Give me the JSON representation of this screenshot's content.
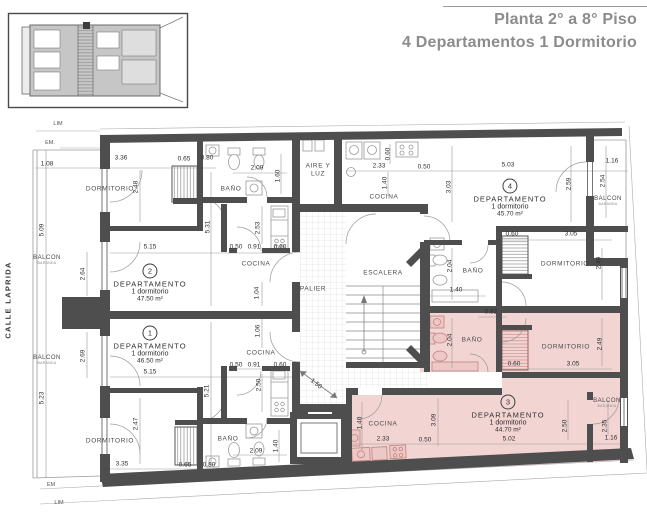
{
  "header": {
    "title_line1": "Planta 2° a 8° Piso",
    "title_line2": "4 Departamentos 1 Dormitorio"
  },
  "street_name": "CALLE LAPRIDA",
  "colors": {
    "highlight_pink": "#f2d5d3",
    "wall_gray": "#4e4e4e",
    "title_gray": "#8c8c8c"
  },
  "site_markers": [
    {
      "text": "LIM",
      "x": 58,
      "y": 124
    },
    {
      "text": "EM.",
      "x": 50,
      "y": 143
    },
    {
      "text": "EM",
      "x": 51,
      "y": 485
    },
    {
      "text": "LIM",
      "x": 59,
      "y": 503
    }
  ],
  "apartments": [
    {
      "number": "2",
      "name": "DEPARTAMENTO",
      "type": "1 dormitorio",
      "area": "47.50 m²",
      "x": 150,
      "y": 283
    },
    {
      "number": "1",
      "name": "DEPARTAMENTO",
      "type": "1 dormitorio",
      "area": "46.50 m²",
      "x": 150,
      "y": 345
    },
    {
      "number": "4",
      "name": "DEPARTAMENTO",
      "type": "1 dormitorio",
      "area": "45.70 m²",
      "x": 510,
      "y": 198
    },
    {
      "number": "3",
      "name": "DEPARTAMENTO",
      "type": "1 dormitorio",
      "area": "44.70 m²",
      "x": 508,
      "y": 414
    }
  ],
  "rooms": [
    {
      "label": "DORMITORIO",
      "x": 110,
      "y": 189
    },
    {
      "label": "BAÑO",
      "x": 231,
      "y": 189
    },
    {
      "label": "COCINA",
      "x": 256,
      "y": 264
    },
    {
      "label": "AIRE Y LUZ",
      "x": 318,
      "y": 171,
      "wrap": true
    },
    {
      "label": "ESCALERA",
      "x": 383,
      "y": 273
    },
    {
      "label": "PALIER",
      "x": 313,
      "y": 289
    },
    {
      "label": "COCINA",
      "x": 384,
      "y": 197
    },
    {
      "label": "DORMITORIO",
      "x": 565,
      "y": 264
    },
    {
      "label": "BAÑO",
      "x": 473,
      "y": 271
    },
    {
      "label": "BAÑO",
      "x": 472,
      "y": 340
    },
    {
      "label": "DORMITORIO",
      "x": 566,
      "y": 347
    },
    {
      "label": "COCINA",
      "x": 383,
      "y": 424
    },
    {
      "label": "DORMITORIO",
      "x": 110,
      "y": 441
    },
    {
      "label": "BAÑO",
      "x": 228,
      "y": 439
    },
    {
      "label": "COCINA",
      "x": 261,
      "y": 353
    }
  ],
  "balconies": [
    {
      "label": "BALCON",
      "note": "BARANDA",
      "x": 47,
      "y": 260
    },
    {
      "label": "BALCON",
      "note": "BARANDA",
      "x": 47,
      "y": 360
    },
    {
      "label": "BALCON",
      "note": "BARANDA",
      "x": 608,
      "y": 201
    },
    {
      "label": "BALCON",
      "note": "BARANDA",
      "x": 607,
      "y": 403
    }
  ],
  "dimensions": [
    {
      "value": "1.08",
      "x": 47,
      "y": 164
    },
    {
      "value": "3.36",
      "x": 121,
      "y": 158
    },
    {
      "value": "0.65",
      "x": 184,
      "y": 159
    },
    {
      "value": "0.80",
      "x": 207,
      "y": 158
    },
    {
      "value": "2.48",
      "x": 136,
      "y": 187,
      "rot": -90
    },
    {
      "value": "5.09",
      "x": 42,
      "y": 230,
      "rot": -90
    },
    {
      "value": "5.15",
      "x": 150,
      "y": 247
    },
    {
      "value": "5.31",
      "x": 208,
      "y": 227,
      "rot": -90
    },
    {
      "value": "2.64",
      "x": 83,
      "y": 274,
      "rot": -90
    },
    {
      "value": "2.69",
      "x": 83,
      "y": 356,
      "rot": -90
    },
    {
      "value": "5.23",
      "x": 42,
      "y": 398,
      "rot": -90
    },
    {
      "value": "5.15",
      "x": 150,
      "y": 372
    },
    {
      "value": "2.47",
      "x": 136,
      "y": 424,
      "rot": -90
    },
    {
      "value": "3.35",
      "x": 122,
      "y": 464
    },
    {
      "value": "0.65",
      "x": 185,
      "y": 465
    },
    {
      "value": "0.80",
      "x": 209,
      "y": 465
    },
    {
      "value": "2.09",
      "x": 257,
      "y": 168
    },
    {
      "value": "1.60",
      "x": 278,
      "y": 176,
      "rot": -90
    },
    {
      "value": "2.53",
      "x": 258,
      "y": 228,
      "rot": -90
    },
    {
      "value": "0.50",
      "x": 236,
      "y": 247
    },
    {
      "value": "0.91",
      "x": 254,
      "y": 247
    },
    {
      "value": "0.60",
      "x": 280,
      "y": 247
    },
    {
      "value": "1.04",
      "x": 257,
      "y": 293,
      "rot": -90
    },
    {
      "value": "1.06",
      "x": 258,
      "y": 331,
      "rot": -90
    },
    {
      "value": "0.50",
      "x": 236,
      "y": 365
    },
    {
      "value": "0.91",
      "x": 254,
      "y": 365
    },
    {
      "value": "0.60",
      "x": 280,
      "y": 365
    },
    {
      "value": "2.50",
      "x": 259,
      "y": 385,
      "rot": -90
    },
    {
      "value": "5.21",
      "x": 207,
      "y": 391,
      "rot": -90
    },
    {
      "value": "2.09",
      "x": 256,
      "y": 451
    },
    {
      "value": "1.40",
      "x": 276,
      "y": 446,
      "rot": -90
    },
    {
      "value": "1.50",
      "x": 316,
      "y": 384,
      "rot": 38
    },
    {
      "value": "2.33",
      "x": 379,
      "y": 166
    },
    {
      "value": "0.60",
      "x": 388,
      "y": 154,
      "rot": -90
    },
    {
      "value": "0.50",
      "x": 424,
      "y": 167
    },
    {
      "value": "1.40",
      "x": 385,
      "y": 183,
      "rot": -90
    },
    {
      "value": "3.03",
      "x": 449,
      "y": 187,
      "rot": -90
    },
    {
      "value": "5.03",
      "x": 508,
      "y": 165
    },
    {
      "value": "2.59",
      "x": 569,
      "y": 184,
      "rot": -90
    },
    {
      "value": "1.16",
      "x": 612,
      "y": 161
    },
    {
      "value": "2.54",
      "x": 603,
      "y": 181,
      "rot": -90
    },
    {
      "value": "0.60",
      "x": 512,
      "y": 234
    },
    {
      "value": "3.05",
      "x": 571,
      "y": 234
    },
    {
      "value": "2.49",
      "x": 599,
      "y": 263,
      "rot": -90
    },
    {
      "value": "2.04",
      "x": 450,
      "y": 266,
      "rot": -90
    },
    {
      "value": "1.40",
      "x": 456,
      "y": 290
    },
    {
      "value": "0.82",
      "x": 491,
      "y": 312
    },
    {
      "value": "2.04",
      "x": 450,
      "y": 340,
      "rot": -90
    },
    {
      "value": "2.49",
      "x": 600,
      "y": 344,
      "rot": -90
    },
    {
      "value": "0.60",
      "x": 514,
      "y": 364
    },
    {
      "value": "3.05",
      "x": 573,
      "y": 364
    },
    {
      "value": "1.40",
      "x": 360,
      "y": 423,
      "rot": -90
    },
    {
      "value": "3.09",
      "x": 434,
      "y": 420,
      "rot": -90
    },
    {
      "value": "2.33",
      "x": 383,
      "y": 439
    },
    {
      "value": "0.50",
      "x": 425,
      "y": 440
    },
    {
      "value": "5.02",
      "x": 509,
      "y": 439
    },
    {
      "value": "2.50",
      "x": 565,
      "y": 426,
      "rot": -90
    },
    {
      "value": "2.35",
      "x": 605,
      "y": 426,
      "rot": -90
    },
    {
      "value": "1.16",
      "x": 611,
      "y": 438
    }
  ]
}
